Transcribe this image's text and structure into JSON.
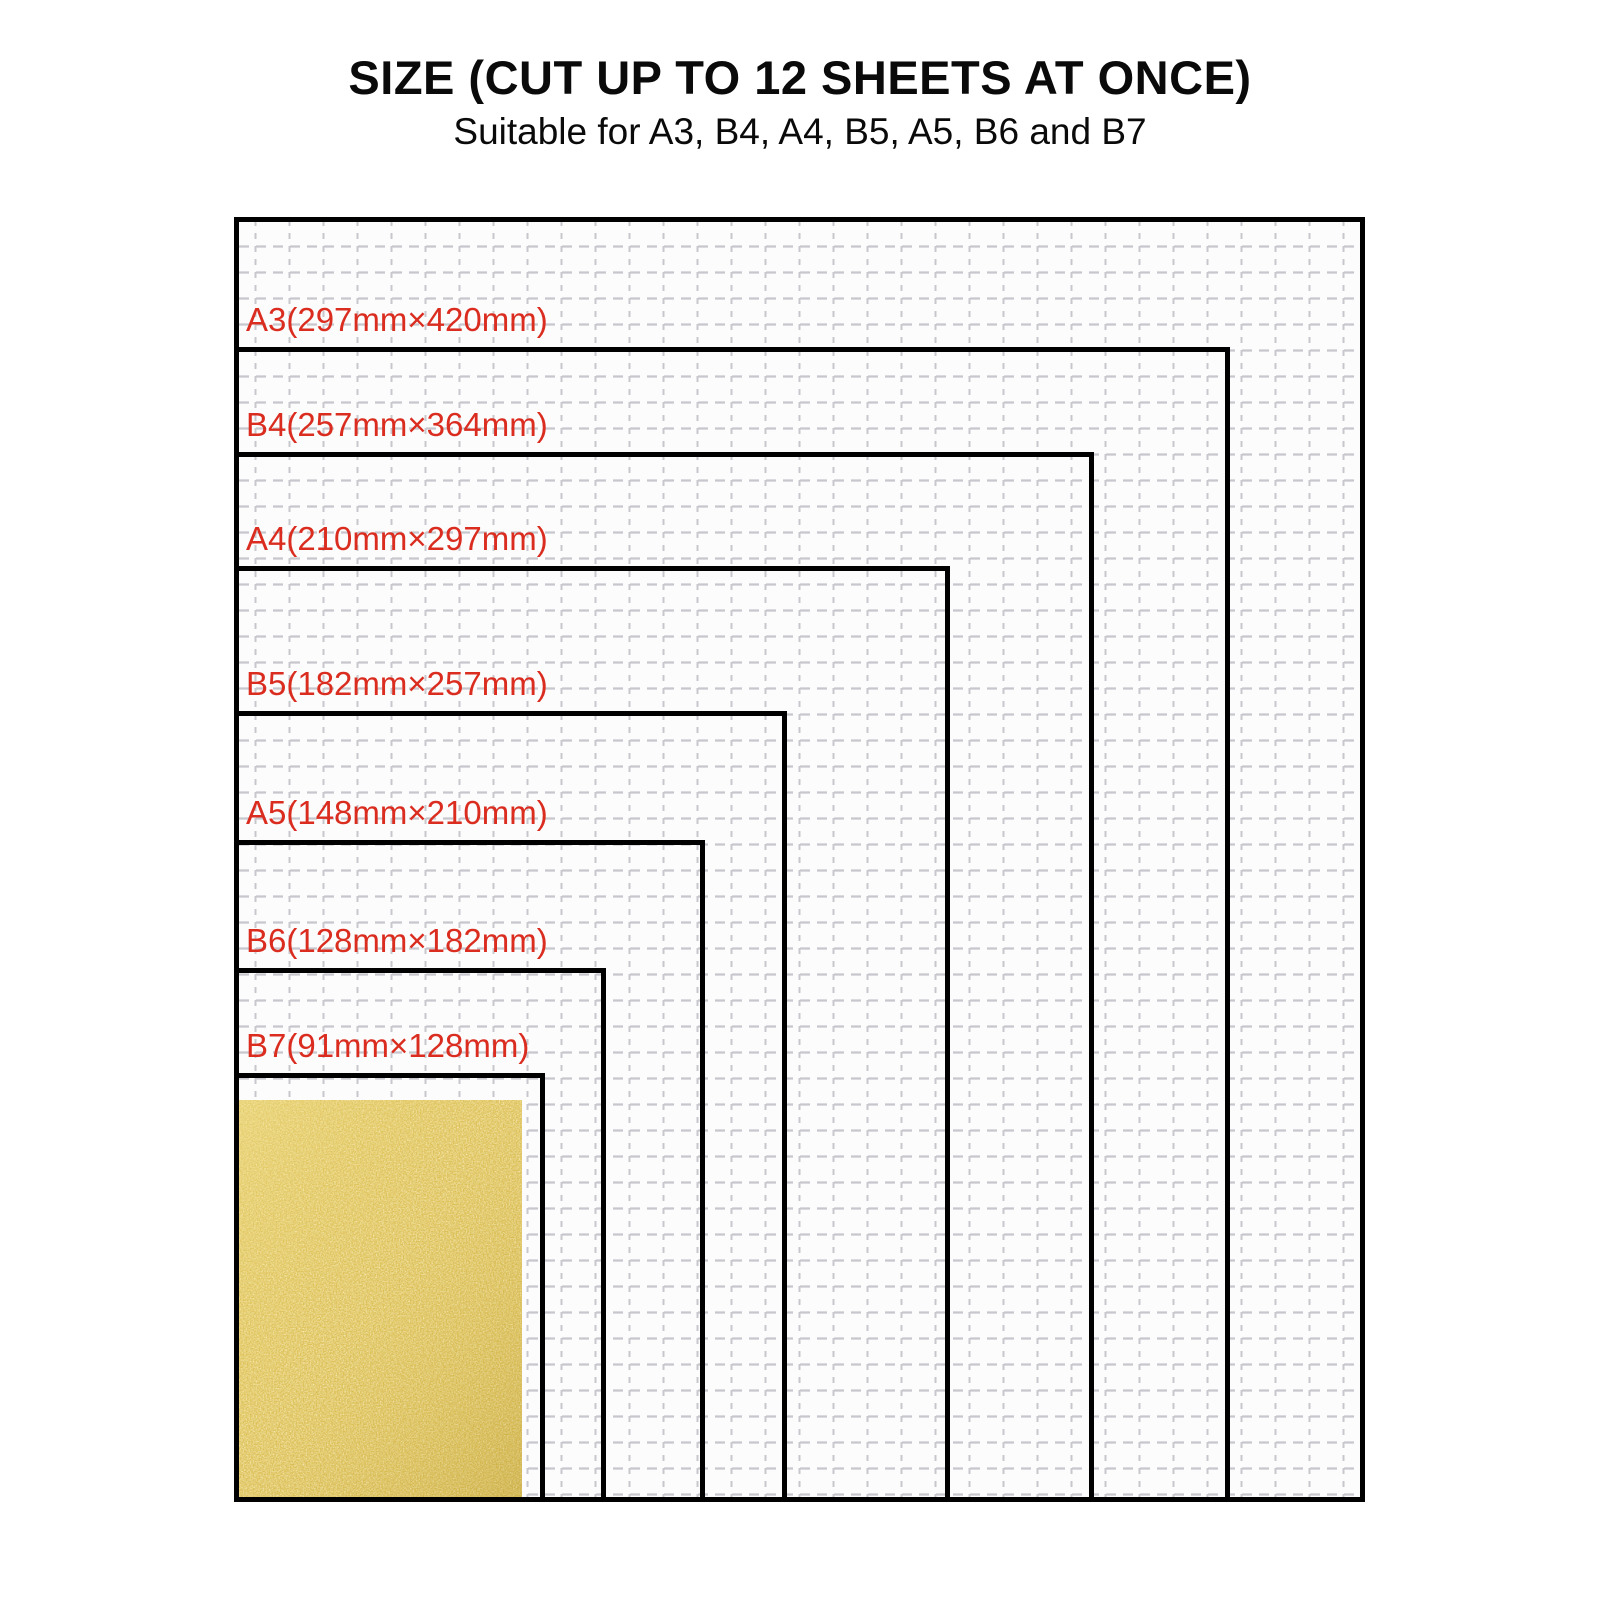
{
  "header": {
    "title": "SIZE (CUT UP TO 12 SHEETS AT ONCE)",
    "subtitle": "Suitable for A3, B4, A4, B5, A5, B6 and B7"
  },
  "diagram": {
    "sizes": [
      {
        "id": "A3",
        "label": "A3(297mm×420mm)"
      },
      {
        "id": "B4",
        "label": "B4(257mm×364mm)"
      },
      {
        "id": "A4",
        "label": "A4(210mm×297mm)"
      },
      {
        "id": "B5",
        "label": "B5(182mm×257mm)"
      },
      {
        "id": "A5",
        "label": "A5(148mm×210mm)"
      },
      {
        "id": "B6",
        "label": "B6(128mm×182mm)"
      },
      {
        "id": "B7",
        "label": "B7(91mm×128mm)"
      }
    ],
    "colors": {
      "label_red": "#da2c1f",
      "border_black": "#000000",
      "gold_base": "#dcbc4e",
      "grid_line": "#c7c7cd"
    }
  }
}
